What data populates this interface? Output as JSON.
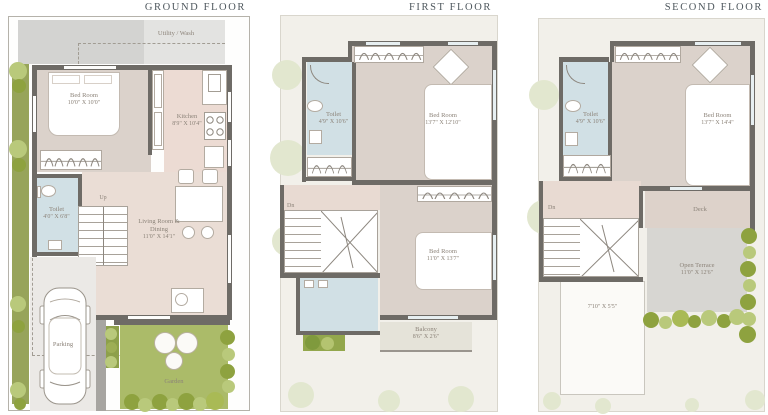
{
  "floors": {
    "ground": {
      "title": "GROUND FLOOR",
      "utility_label": "Utility / Wash",
      "bedroom": {
        "name": "Bed Room",
        "dims": "10'0\" X 10'0\""
      },
      "kitchen": {
        "name": "Kitchen",
        "dims": "8'9\" X 10'4\""
      },
      "toilet": {
        "name": "Toilet",
        "dims": "4'0\" X 6'8\""
      },
      "living": {
        "name": "Living Room & Dining",
        "dims": "11'0\" X 14'1\""
      },
      "stairs_label": "Up",
      "parking_label": "Parking",
      "garden_label": "Garden"
    },
    "first": {
      "title": "FIRST FLOOR",
      "toilet": {
        "name": "Toilet",
        "dims": "4'9\" X 10'6\""
      },
      "bedroom1": {
        "name": "Bed Room",
        "dims": "13'7\" X 12'10\""
      },
      "bedroom2": {
        "name": "Bed Room",
        "dims": "11'0\" X 13'7\""
      },
      "balcony": {
        "name": "Balcony",
        "dims": "8'6\" X 2'6\""
      },
      "stairs_label": "Dn"
    },
    "second": {
      "title": "SECOND FLOOR",
      "toilet": {
        "name": "Toilet",
        "dims": "4'9\" X 10'6\""
      },
      "bedroom": {
        "name": "Bed Room",
        "dims": "13'7\" X 14'4\""
      },
      "stairs_label": "Dn",
      "deck_label": "Deck",
      "terrace": {
        "name": "Open Terrace",
        "dims": "11'0\" X 12'6\""
      },
      "roof_dims": "7'10\" X 5'5\""
    }
  },
  "colors": {
    "wall": "#6e6b66",
    "bedroom_floor": "#dbd2cb",
    "living_floor": "#eadde5",
    "kitchen_floor": "#ecdbd3",
    "toilet_floor": "#d1e0e5",
    "terrace": "#d7d6d2",
    "deck": "#ddd2ca",
    "garden": "#abbb69",
    "hedge_dark": "#8ea23f",
    "hedge_light": "#b9c97b"
  }
}
